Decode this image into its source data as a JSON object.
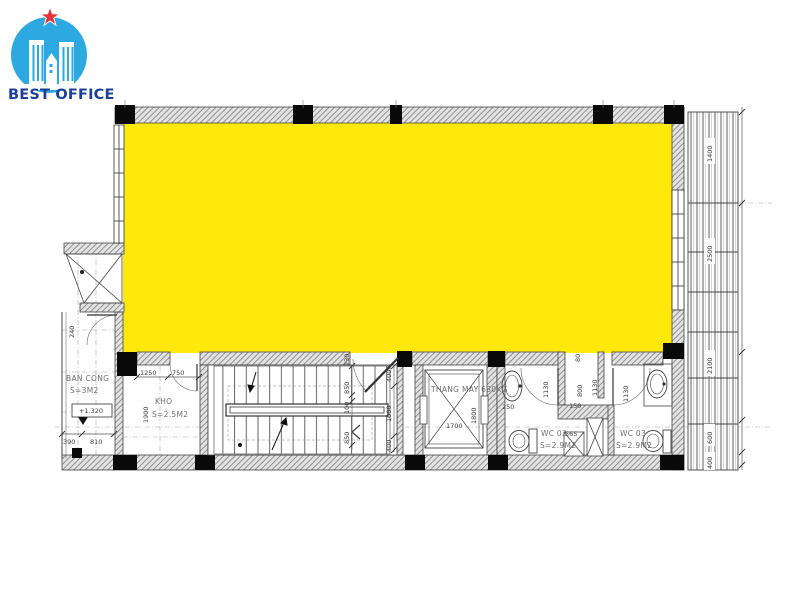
{
  "logo": {
    "title": "BEST OFFICE"
  },
  "colors": {
    "brand_blue": "#2BA9E0",
    "brand_dark_blue": "#1C3F94",
    "star_red": "#E63338",
    "highlight_yellow": "#FFE80A",
    "line": "#3c3c3c"
  },
  "rooms": {
    "balcony": {
      "name": "BAN CONG",
      "area": "S=3M2",
      "level": "+1.320"
    },
    "storage": {
      "name": "KHO",
      "area": "S=2.5M2"
    },
    "elevator": {
      "name": "THANG MAY 630KG"
    },
    "wc02": {
      "name": "WC 02",
      "area": "S=2.9M2"
    },
    "wc03": {
      "name": "WC 03",
      "area": "S=2.9M2"
    }
  },
  "dims": {
    "balcony_240": "240",
    "balcony_390": "390",
    "balcony_810": "810",
    "kho_1250": "1250",
    "kho_750": "750",
    "kho_1900": "1900",
    "stair_230": "230",
    "stair_850a": "850",
    "stair_100": "100",
    "stair_850b": "850",
    "corridor_400a": "400",
    "corridor_1000": "1000",
    "corridor_400b": "400",
    "lift_1800": "1800",
    "lift_1700": "1700",
    "wc02_250": "250",
    "wc02_1130": "1130",
    "vest_80": "80",
    "vest_800": "800",
    "vest_1130": "1130",
    "vest_150": "150",
    "vest_565": "565",
    "wc03_1130": "1130",
    "louver_1400": "1400",
    "louver_2500": "2500",
    "louver_2100": "2100",
    "louver_600": "600",
    "louver_400": "400"
  }
}
